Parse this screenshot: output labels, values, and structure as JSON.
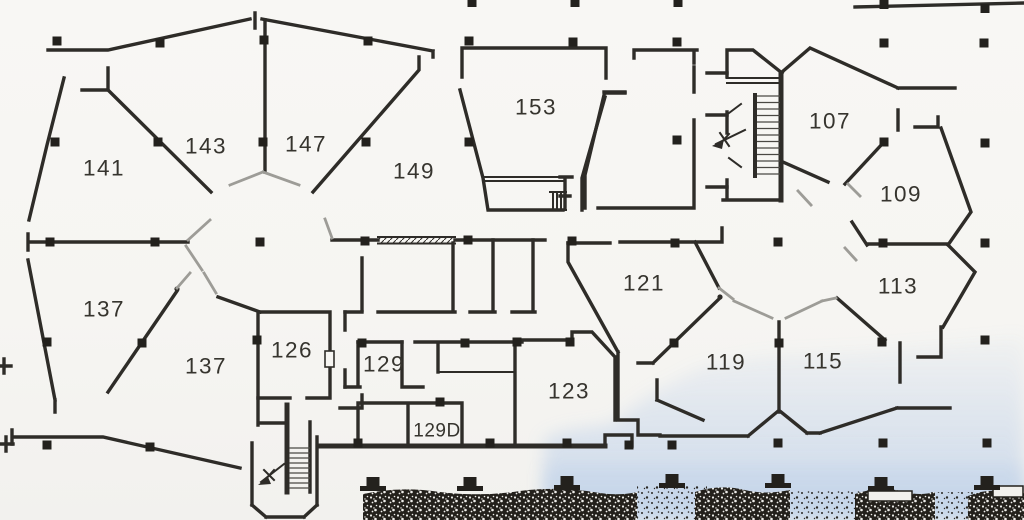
{
  "plan": {
    "type": "architectural-floor-plan",
    "rooms": [
      {
        "number": "141",
        "x": 104,
        "y": 168
      },
      {
        "number": "143",
        "x": 206,
        "y": 146
      },
      {
        "number": "147",
        "x": 306,
        "y": 144
      },
      {
        "number": "149",
        "x": 414,
        "y": 171
      },
      {
        "number": "153",
        "x": 536,
        "y": 107
      },
      {
        "number": "107",
        "x": 830,
        "y": 121
      },
      {
        "number": "109",
        "x": 901,
        "y": 194
      },
      {
        "number": "113",
        "x": 898,
        "y": 286
      },
      {
        "number": "121",
        "x": 644,
        "y": 283
      },
      {
        "number": "119",
        "x": 726,
        "y": 362
      },
      {
        "number": "115",
        "x": 823,
        "y": 361
      },
      {
        "number": "137",
        "x": 104,
        "y": 309
      },
      {
        "number": "137",
        "x": 206,
        "y": 366
      },
      {
        "number": "126",
        "x": 292,
        "y": 350
      },
      {
        "number": "129",
        "x": 384,
        "y": 364
      },
      {
        "number": "129D",
        "x": 437,
        "y": 431,
        "small": true
      },
      {
        "number": "123",
        "x": 569,
        "y": 391
      }
    ],
    "symbols": [
      {
        "name": "stairwell-upper-right-icon"
      },
      {
        "name": "stairwell-lower-left-icon"
      },
      {
        "name": "column-grid-squares"
      },
      {
        "name": "window-hatch"
      },
      {
        "name": "survey-cross-markers"
      },
      {
        "name": "vegetation-band"
      }
    ],
    "colors": {
      "paper": "#f6f5f2",
      "ink": "#2e2c28",
      "door_gray": "#9d9c97",
      "blue_wash": "#c7d7ec",
      "vegetation": "#23201b",
      "label": "#36342e"
    }
  }
}
